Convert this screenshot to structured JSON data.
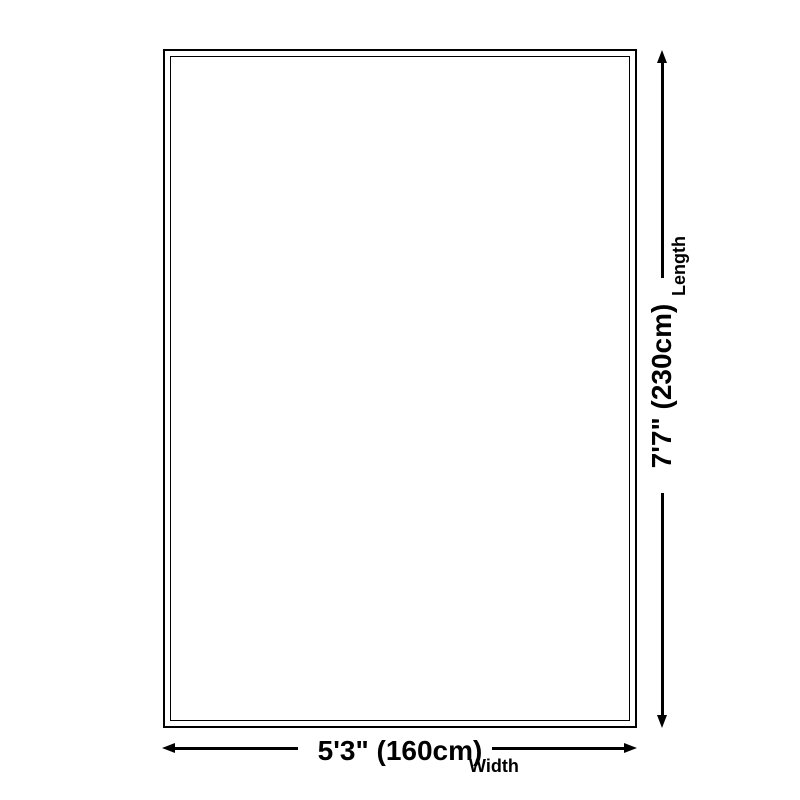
{
  "page": {
    "background": "#ffffff",
    "ink": "#000000"
  },
  "diagram": {
    "type": "rug-size-diagram",
    "width_dimension": {
      "value": "5'3\" (160cm)",
      "label": "Width"
    },
    "length_dimension": {
      "value": "7'7\" (230cm)",
      "label": "Length"
    }
  }
}
